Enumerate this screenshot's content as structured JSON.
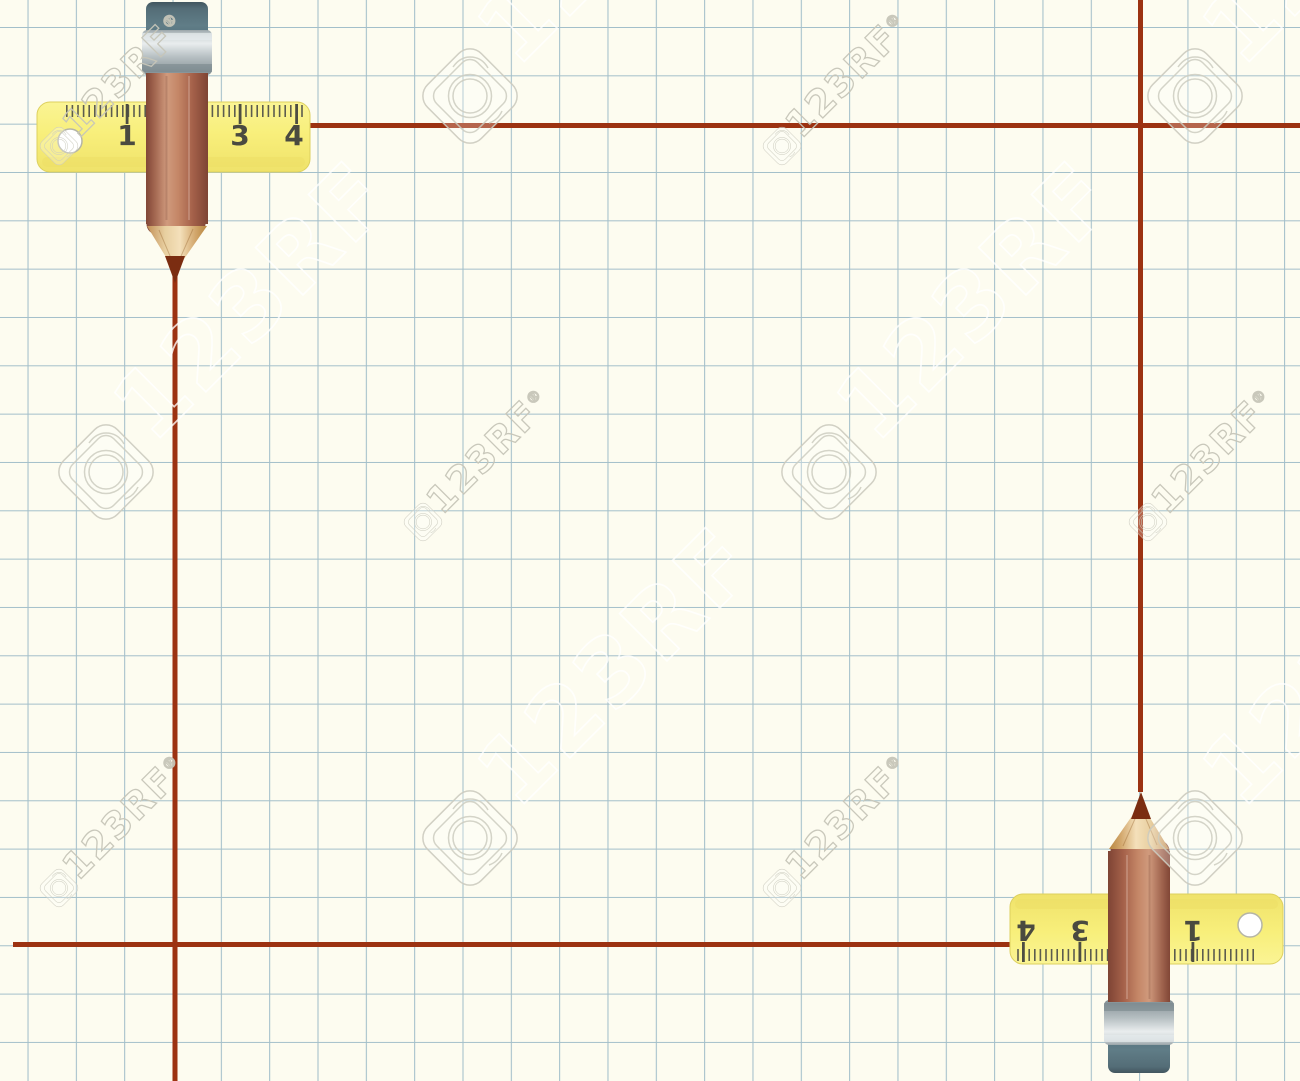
{
  "scene": {
    "watermark": {
      "text": "123RF",
      "registered_mark": "®"
    },
    "top_ruler": {
      "numbers": [
        "1",
        "3",
        "4"
      ]
    },
    "bottom_ruler": {
      "numbers": [
        "4",
        "3",
        "1"
      ]
    },
    "colors": {
      "paper": "#fdfcf0",
      "grid_line": "#a3bfca",
      "drawn_line": "#9c3211",
      "ruler_yellow": "#f8ef7c",
      "ruler_numbers": "#4a4a40",
      "pencil_body": "#c0805f",
      "pencil_eraser": "#5d737e",
      "pencil_ferrule": "#c3cbce",
      "pencil_wood": "#ecd3a4",
      "pencil_lead": "#7b2d11"
    }
  }
}
